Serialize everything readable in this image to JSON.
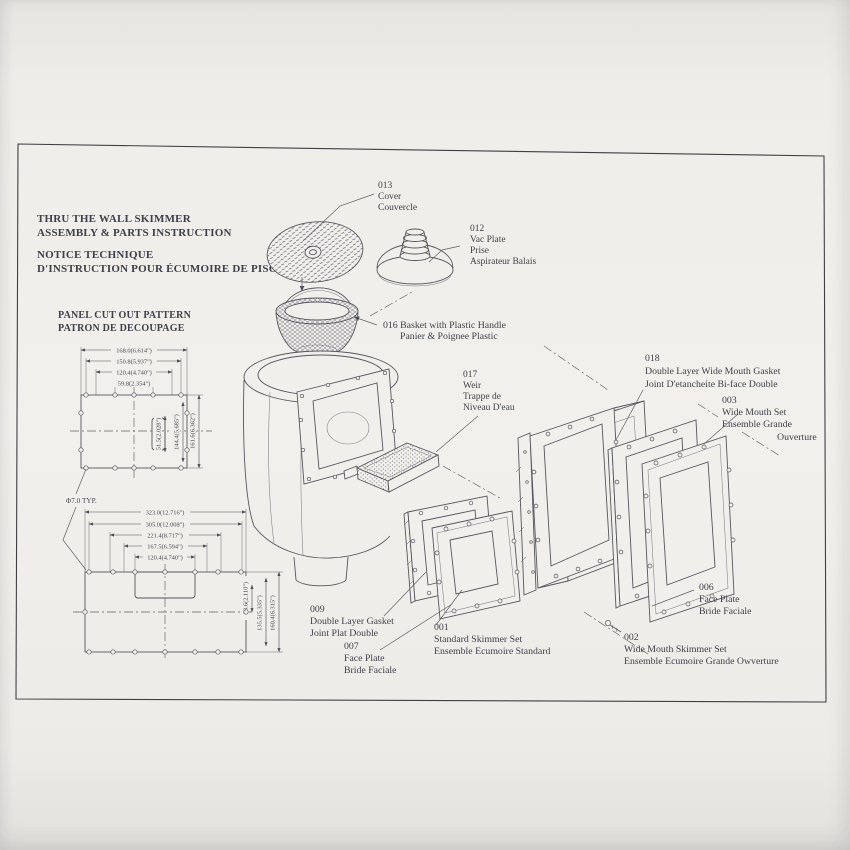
{
  "header": {
    "title_en_1": "THRU THE WALL SKIMMER",
    "title_en_2": "ASSEMBLY & PARTS INSTRUCTION",
    "title_fr_1": "NOTICE TECHNIQUE",
    "title_fr_2": "D'INSTRUCTION POUR ÉCUMOIRE DE PISCINE"
  },
  "pattern": {
    "title1": "PANEL CUT OUT PATTERN",
    "title2": "PATRON DE DECOUPAGE",
    "hole": "Φ7.0 TYP.",
    "p1": {
      "w": [
        "168.0(6.614\")",
        "150.8(5.937\")",
        "120.4(4.740\")",
        "59.8(2.354\")"
      ],
      "h": [
        "51.5(2.028\")",
        "144.4(5.685\")",
        "161.6(6.362\")"
      ]
    },
    "p2": {
      "w": [
        "323.0(12.716\")",
        "305.0(12.008\")",
        "221.4(8.717\")",
        "167.5(6.594\")",
        "120.4(4.740\")"
      ],
      "h": [
        "53.6(2.110\")",
        "135.5(5.335\")",
        "160.4(6.315\")"
      ]
    }
  },
  "parts": {
    "cover": {
      "num": "013",
      "l1": "Cover",
      "l2": "Couvercle"
    },
    "vac": {
      "num": "012",
      "l1": "Vac Plate",
      "l2": "Prise",
      "l3": "Aspirateur Balais"
    },
    "basket": {
      "l1": "016 Basket with Plastic Handle",
      "l2": "Panier & Poignee Plastic"
    },
    "weir": {
      "num": "017",
      "l1": "Weir",
      "l2": "Trappe de",
      "l3": "Niveau D'eau"
    },
    "wmgasket": {
      "num": "018",
      "l1": "Double Layer Wide Mouth Gasket",
      "l2": "Joint D'etancheite Bi-face Double"
    },
    "wmset": {
      "num": "003",
      "l1": "Wide Mouth Set",
      "l2": "Ensemble Grande",
      "l3": "Ouverture"
    },
    "gasket": {
      "num": "009",
      "l1": "Double Layer Gasket",
      "l2": "Joint Plat Double"
    },
    "stdset": {
      "num": "001",
      "l1": "Standard Skimmer Set",
      "l2": "Ensemble Ecumoire Standard"
    },
    "fp007": {
      "num": "007",
      "l1": "Face Plate",
      "l2": "Bride Faciale"
    },
    "fp006": {
      "num": "006",
      "l1": "Face Plate",
      "l2": "Bride Faciale"
    },
    "wmskimmer": {
      "num": "002",
      "l1": "Wide Mouth Skimmer Set",
      "l2": "Ensemble Ecumoire Grande Owverture"
    }
  }
}
